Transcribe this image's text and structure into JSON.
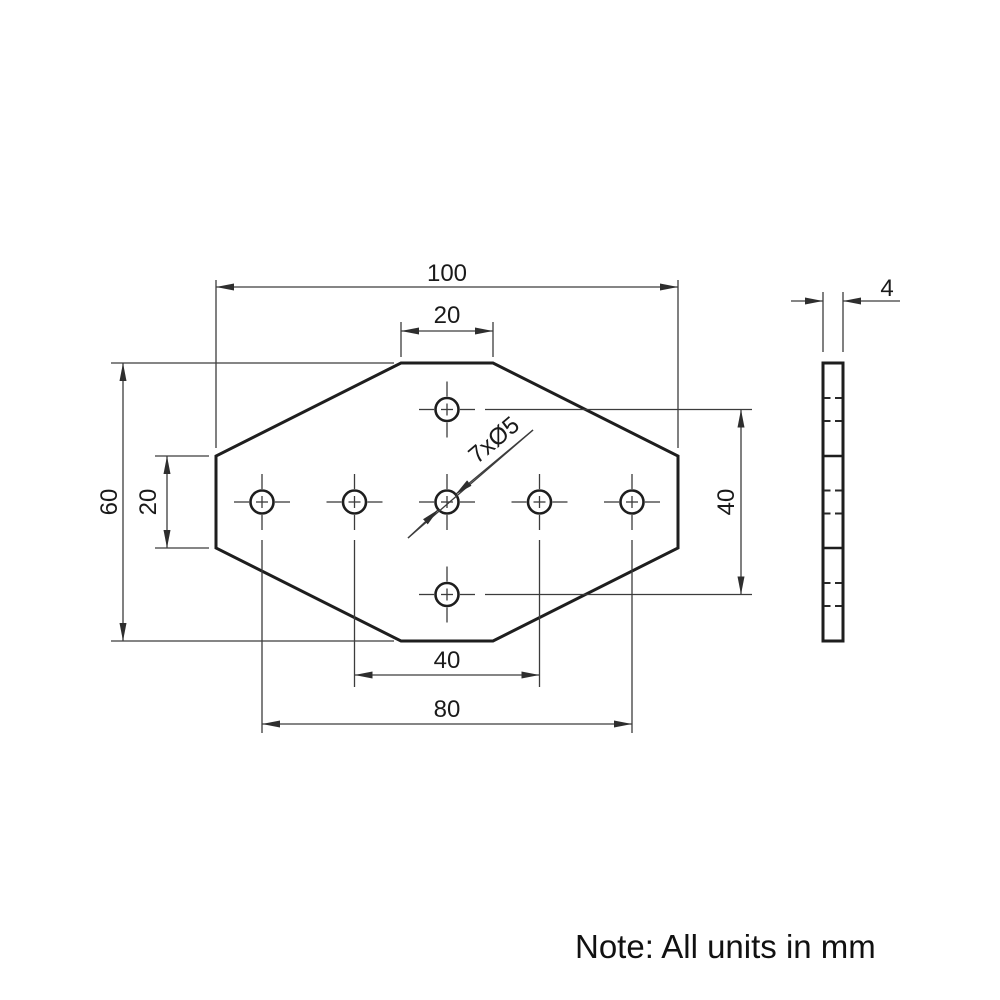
{
  "drawing": {
    "note": "Note: All units in mm",
    "part": {
      "width_mm": 100,
      "height_mm": 60,
      "thickness_mm": 4,
      "hole_count": 7,
      "hole_diameter_mm": 5
    },
    "dimensions": {
      "overall_width": "100",
      "top_flat_width": "20",
      "overall_height": "60",
      "side_flat_height": "20",
      "hole_span_vertical": "40",
      "hole_span_inner": "40",
      "hole_span_outer": "80",
      "thickness": "4",
      "holes_callout": "7xØ5"
    },
    "colors": {
      "thick_line": "#1e1e1e",
      "thin_line": "#3c3c3c",
      "background": "#ffffff"
    }
  }
}
